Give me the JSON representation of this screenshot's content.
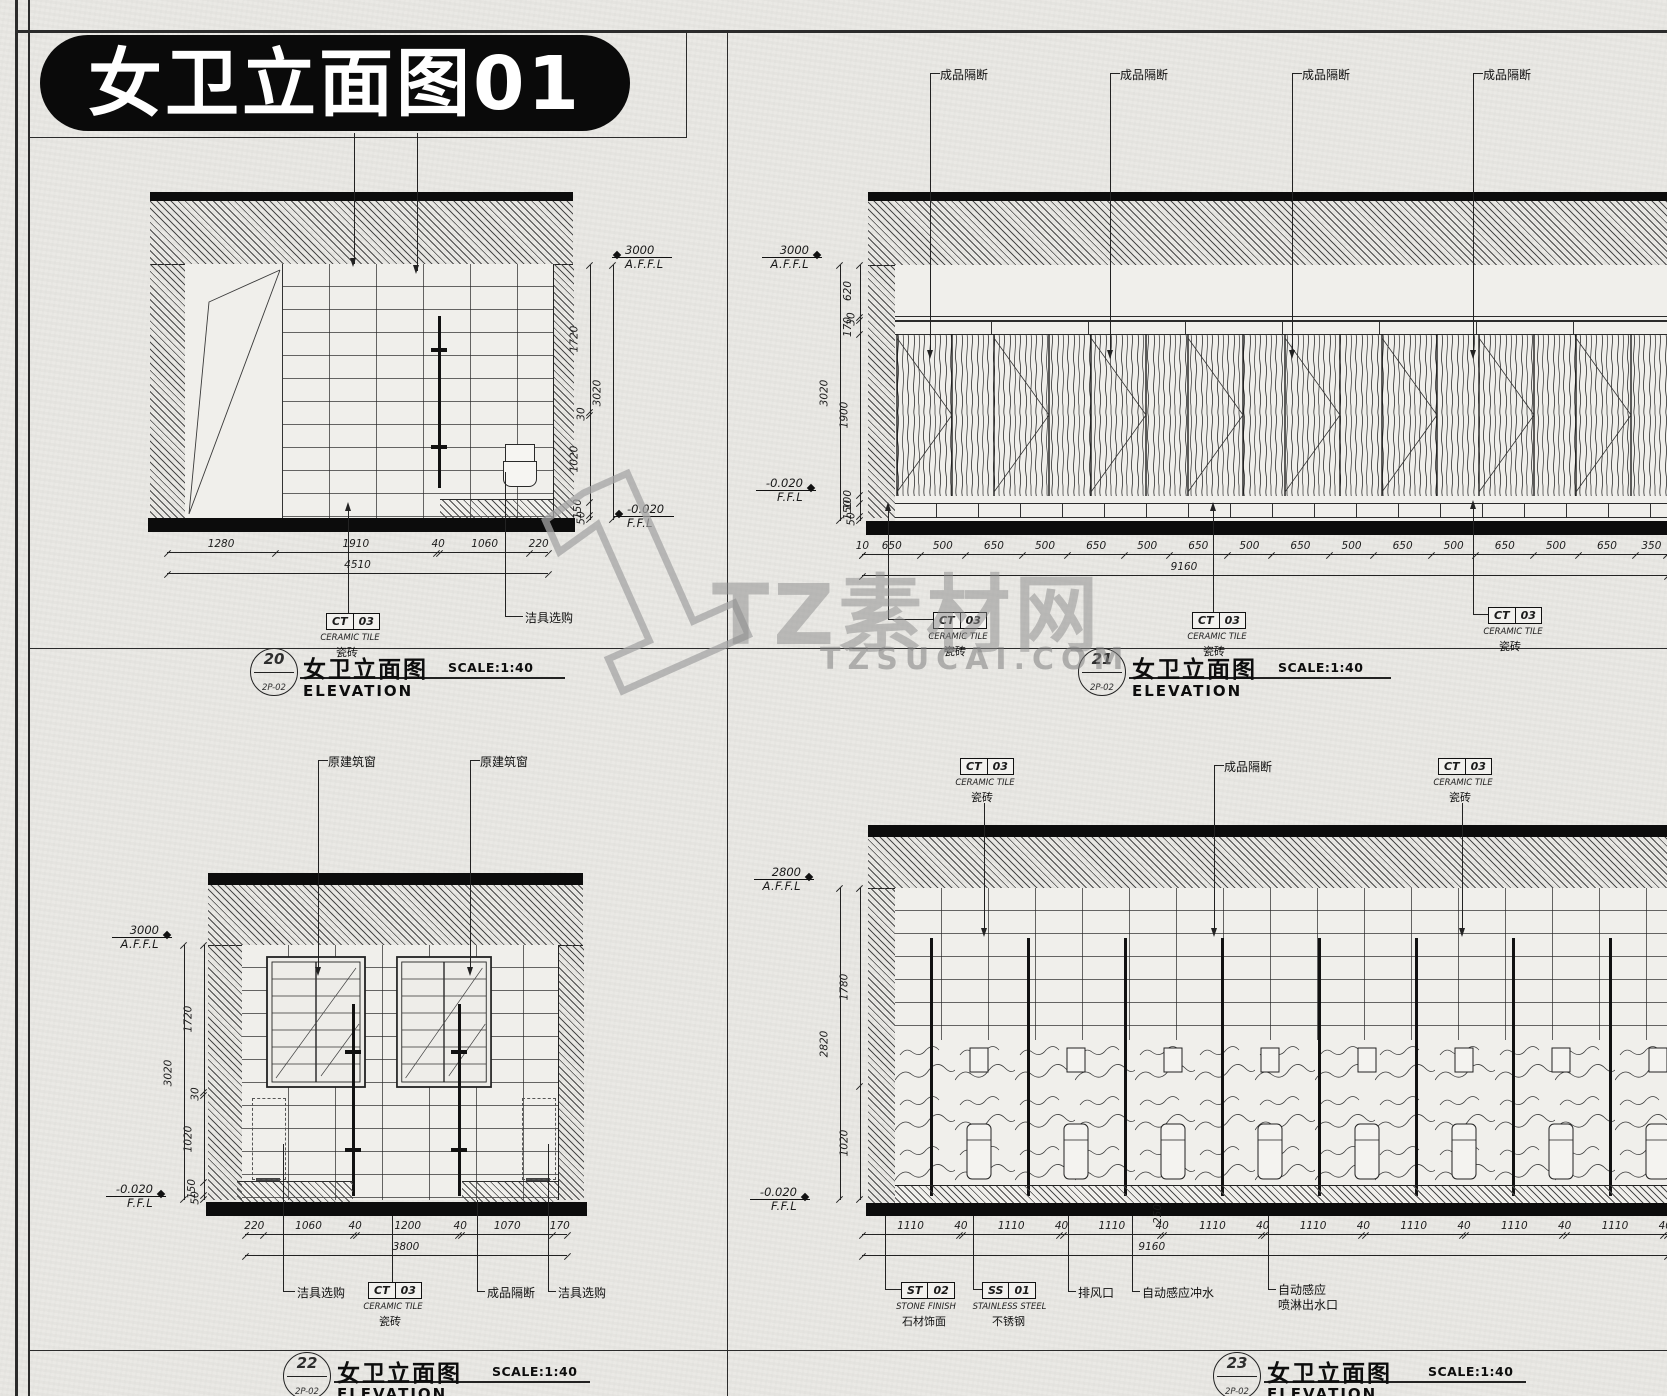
{
  "sheet": {
    "title": "女卫立面图01"
  },
  "watermark": {
    "numeral": "1",
    "brand": "TZ素材网",
    "site": "TZSUCAI.COM"
  },
  "tags": {
    "ct03": {
      "code": "CT",
      "num": "03",
      "en": "CERAMIC TILE",
      "cn": "瓷砖"
    },
    "st02": {
      "code": "ST",
      "num": "02",
      "en": "STONE FINISH",
      "cn": "石材饰面"
    },
    "ss01": {
      "code": "SS",
      "num": "01",
      "en": "STAINLESS STEEL",
      "cn": "不锈钢"
    }
  },
  "labels": {
    "partition": "成品隔断",
    "fixture": "洁具选购",
    "window": "原建筑窗",
    "exhaust": "排风口",
    "auto_flush": "自动感应冲水",
    "auto_spray_line1": "自动感应",
    "auto_spray_line2": "喷淋出水口"
  },
  "levels": {
    "affl": "A.F.F.L",
    "ffl": "F.F.L",
    "minus": "-0.020"
  },
  "views": {
    "v20": {
      "no": "20",
      "ref": "2P-02",
      "name": "女卫立面图",
      "scale": "SCALE:1:40",
      "sub": "ELEVATION",
      "top_level": "3000",
      "side_segs": [
        "1720",
        "30",
        "1020",
        "150",
        "50"
      ],
      "side_total": "3020",
      "bottom_segs": [
        "1280",
        "1910",
        "40",
        "1060",
        "220"
      ],
      "bottom_total": "4510"
    },
    "v21": {
      "no": "21",
      "ref": "2P-02",
      "name": "女卫立面图",
      "scale": "SCALE:1:40",
      "sub": "ELEVATION",
      "top_level": "3000",
      "side_segs": [
        "620",
        "30",
        "170",
        "1900",
        "100",
        "150",
        "50"
      ],
      "side_total": "3020",
      "bottom_segs": [
        "10",
        "650",
        "500",
        "650",
        "500",
        "650",
        "500",
        "650",
        "500",
        "650",
        "500",
        "650",
        "500",
        "650",
        "500",
        "650",
        "350"
      ],
      "bottom_total": "9160"
    },
    "v22": {
      "no": "22",
      "ref": "2P-02",
      "name": "女卫立面图",
      "scale": "SCALE:1:40",
      "sub": "ELEVATION",
      "top_level": "3000",
      "side_segs": [
        "1720",
        "30",
        "1020",
        "150",
        "50"
      ],
      "side_total": "3020",
      "bottom_segs": [
        "220",
        "1060",
        "40",
        "1200",
        "40",
        "1070",
        "170"
      ],
      "bottom_total": "3800"
    },
    "v23": {
      "no": "23",
      "ref": "2P-02",
      "name": "女卫立面图",
      "scale": "SCALE:1:40",
      "sub": "ELEVATION",
      "top_level": "2800",
      "side_segs": [
        "1780",
        "1020"
      ],
      "side_total": "2820",
      "bottom_segs": [
        "1110",
        "40",
        "1110",
        "40",
        "1110",
        "40",
        "1110",
        "40",
        "1110",
        "40",
        "1110",
        "40",
        "1110",
        "40",
        "1110",
        "40"
      ],
      "bottom_total": "9160",
      "riser": "250"
    }
  }
}
